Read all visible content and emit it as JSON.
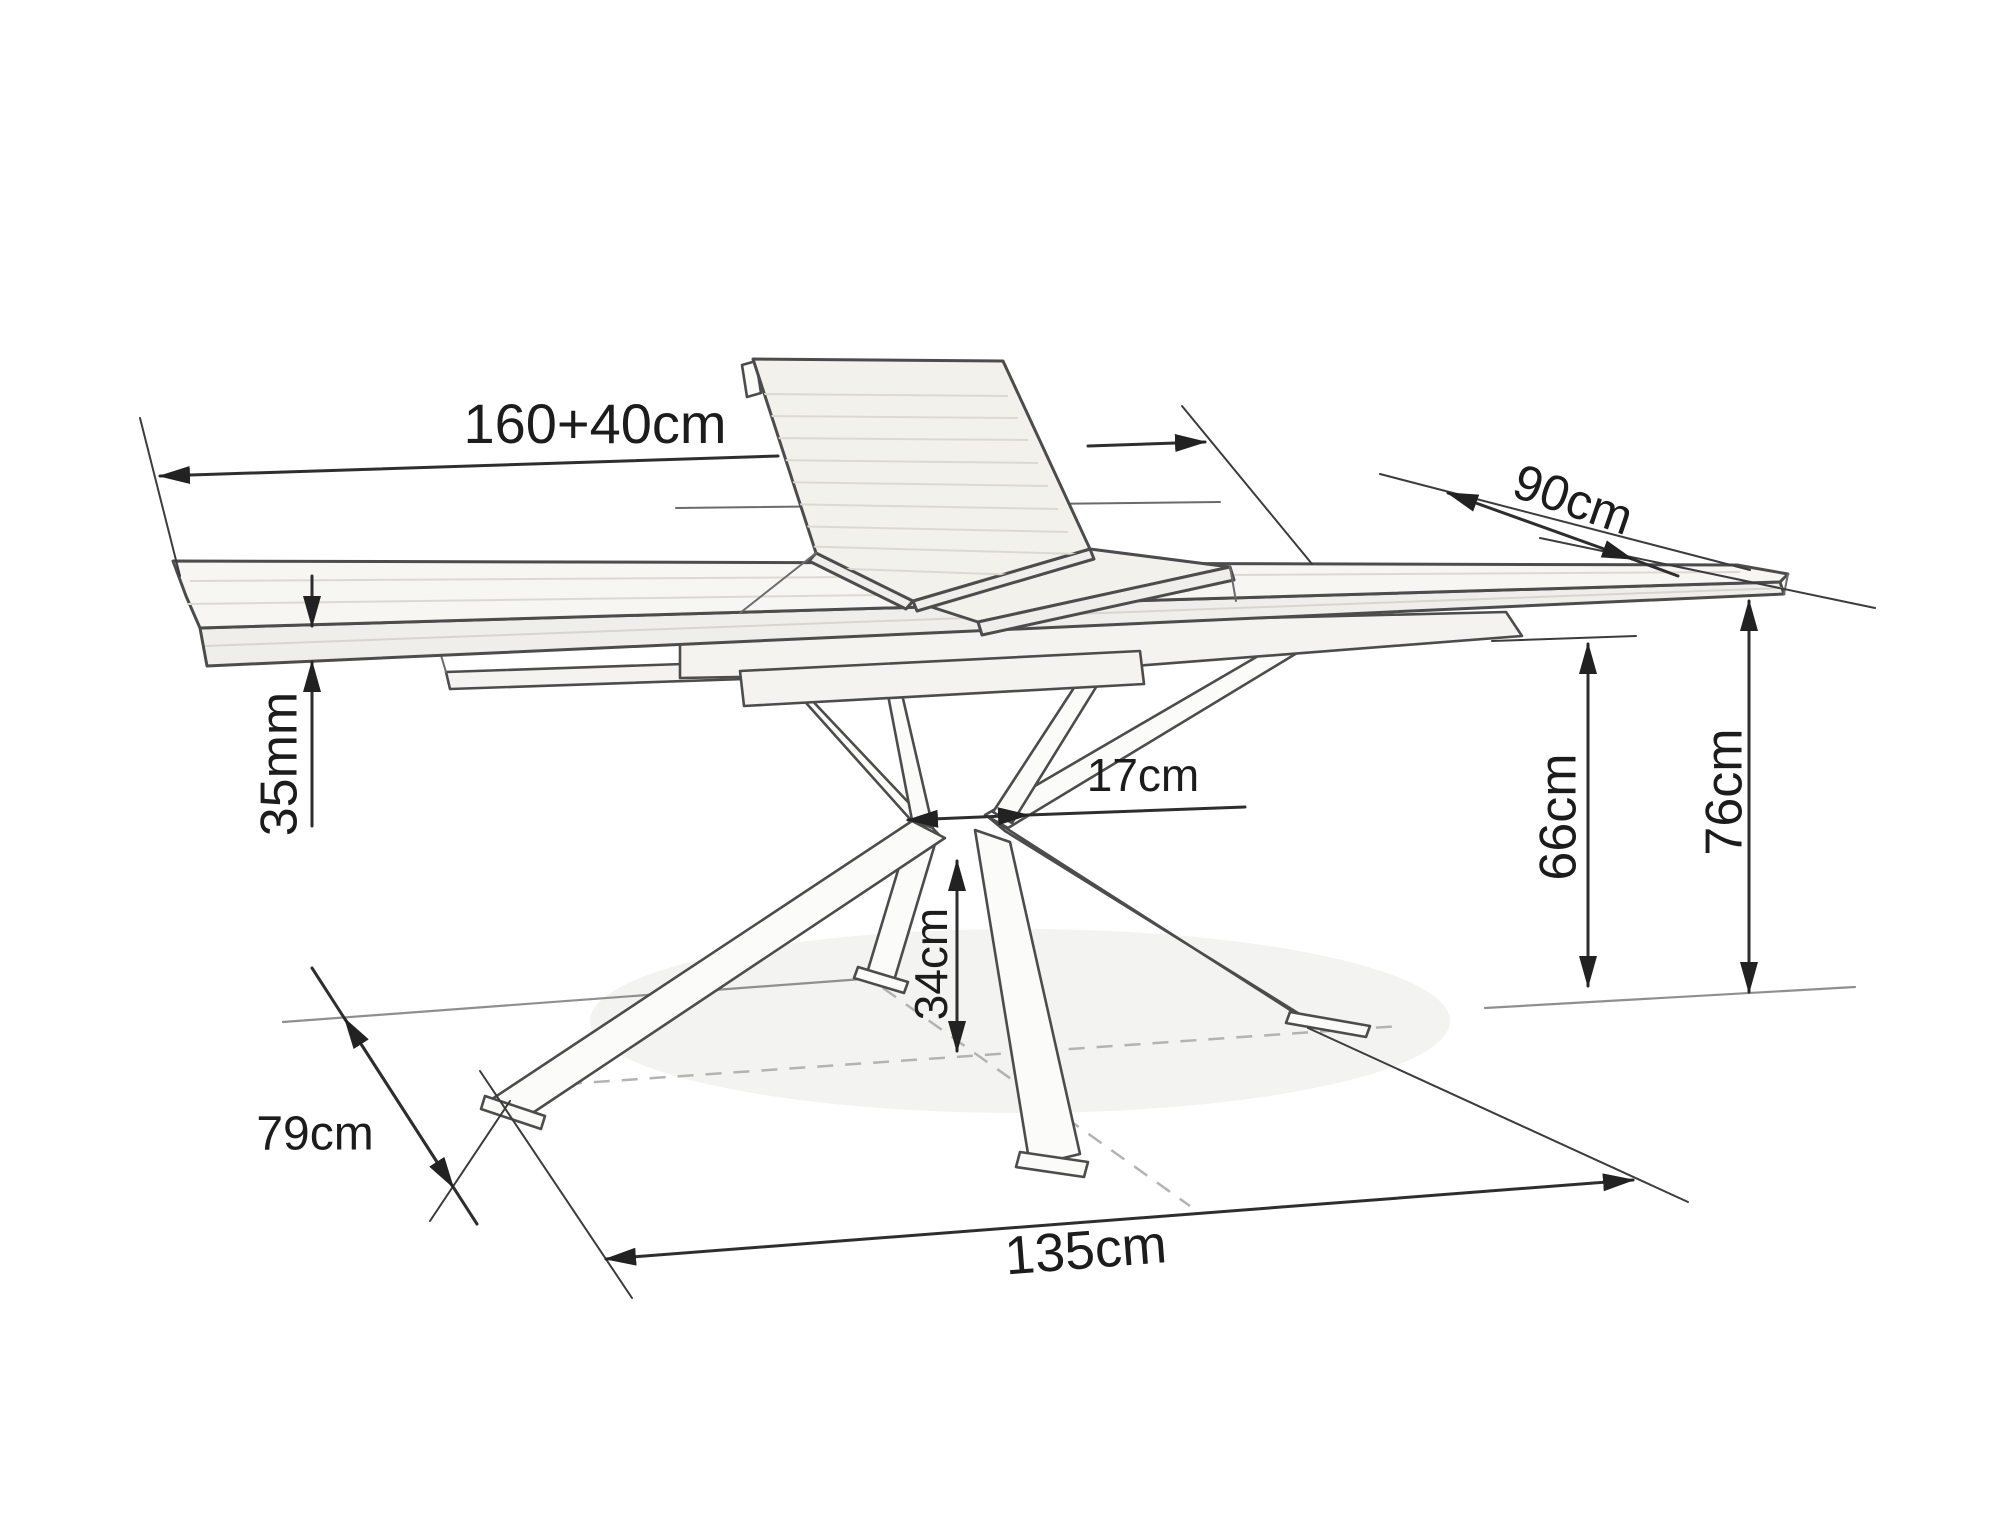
{
  "diagram": {
    "kind": "furniture-dimension-line-drawing",
    "subject": "extendable dining table with spider cross base and raised butterfly leaf",
    "background_color": "#ffffff",
    "ink_color": "#2e2e2e",
    "outline_color": "#4c4c4c",
    "dimensions": {
      "length": {
        "label": "160+40cm"
      },
      "depth": {
        "label": "90cm"
      },
      "top_thickness": {
        "label": "35mm"
      },
      "base_top_gap": {
        "label": "17cm"
      },
      "underside_clearance": {
        "label": "66cm"
      },
      "total_height": {
        "label": "76cm"
      },
      "base_depth": {
        "label": "79cm"
      },
      "base_width": {
        "label": "135cm"
      },
      "column_height": {
        "label": "34cm"
      }
    }
  }
}
